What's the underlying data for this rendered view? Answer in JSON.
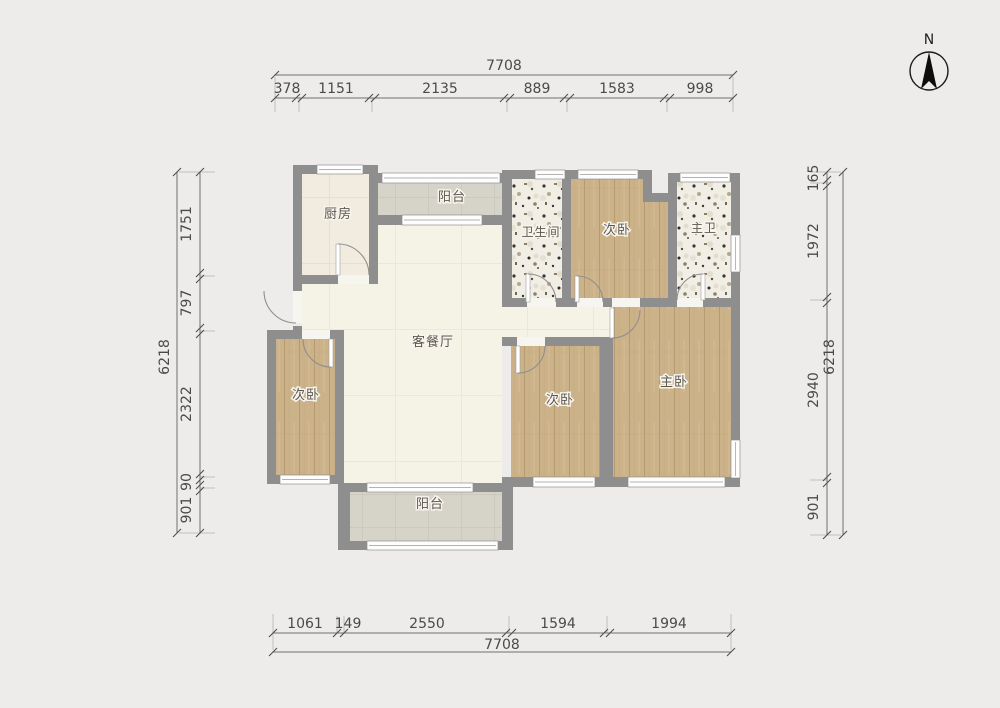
{
  "compass": {
    "label": "N"
  },
  "rooms": {
    "kitchen": {
      "label": "厨房"
    },
    "balcony_top": {
      "label": "阳台"
    },
    "bathroom": {
      "label": "卫生间"
    },
    "bedroom_top": {
      "label": "次卧"
    },
    "master_bathroom": {
      "label": "主卫"
    },
    "living_dining": {
      "label": "客餐厅"
    },
    "bedroom_left": {
      "label": "次卧"
    },
    "bedroom_center": {
      "label": "次卧"
    },
    "master_bedroom": {
      "label": "主卧"
    },
    "balcony_bottom": {
      "label": "阳台"
    }
  },
  "dimensions": {
    "top": {
      "total": "7708",
      "segments": [
        "378",
        "1151",
        "2135",
        "889",
        "1583",
        "998"
      ]
    },
    "bottom": {
      "total": "7708",
      "segments": [
        "1061",
        "149",
        "2550",
        "1594",
        "1994"
      ]
    },
    "left": {
      "total": "6218",
      "segments": [
        "1751",
        "797",
        "2322",
        "90",
        "901"
      ]
    },
    "right": {
      "total": "6218",
      "segments": [
        "165",
        "1972",
        "2940",
        "901"
      ]
    }
  },
  "palette": {
    "background": "#edecea",
    "wall": "#8e8e8e",
    "wood_floor": "#ccb289",
    "living_floor": "#f5f2e6",
    "kitchen_floor": "#f1ecdf",
    "balcony_floor": "#d6d4c9",
    "terrazzo_floor": "#f1eee5",
    "window": "#fdfdfd",
    "dimension_line": "#707070",
    "dimension_text": "#4a4a4a",
    "room_label_text": "#5d584f",
    "north_arrow": "#0d0d0d"
  }
}
